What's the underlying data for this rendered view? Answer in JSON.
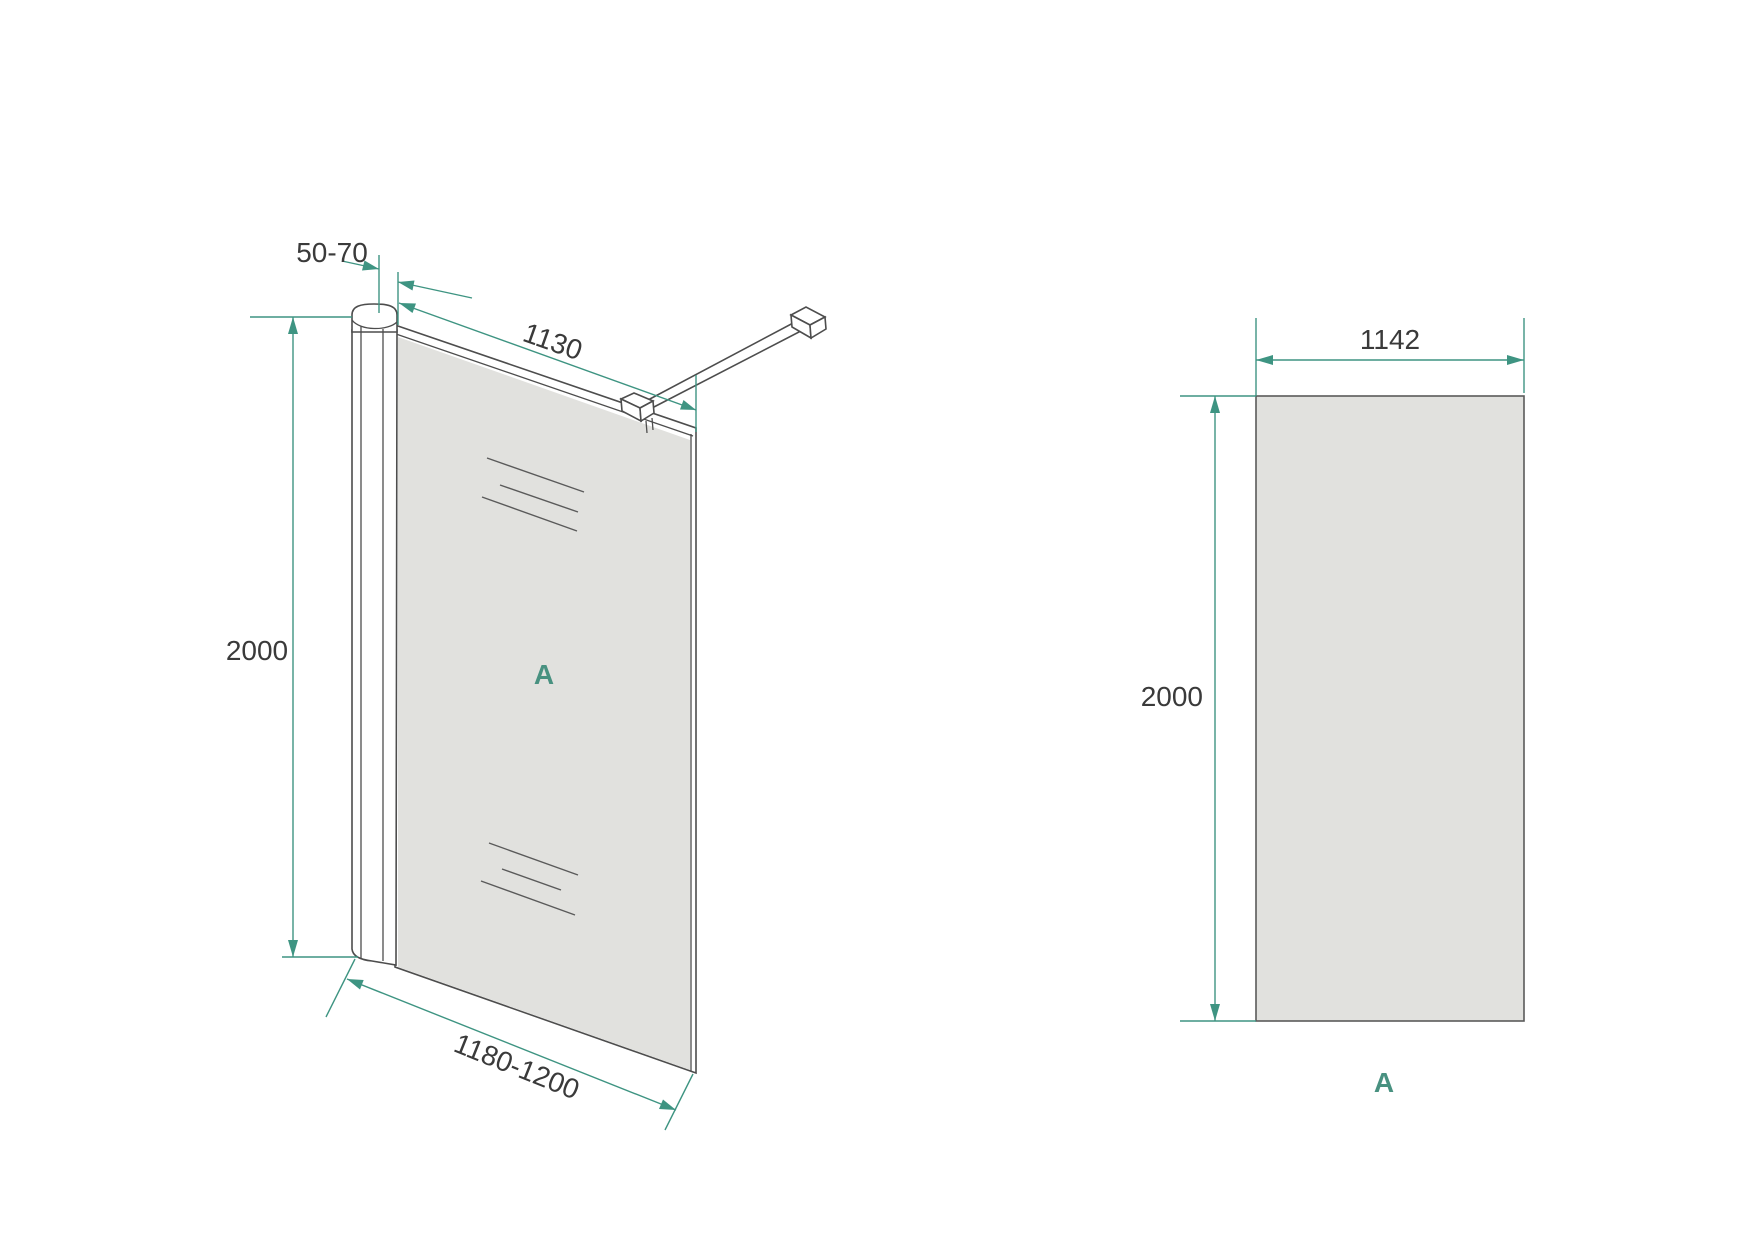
{
  "colors": {
    "accent": "#3E9482",
    "panel_label": "#489180",
    "line": "#4d4d4d",
    "glass_fill": "#E1E1DE",
    "text": "#3a3a3a",
    "background": "#ffffff"
  },
  "side_view": {
    "panel_label": "A",
    "dims": {
      "profile_adjustment": "50-70",
      "glass_width": "1130",
      "height": "2000",
      "install_width": "1180-1200"
    }
  },
  "front_view": {
    "panel_label": "A",
    "dims": {
      "glass_width": "1142",
      "height": "2000"
    }
  }
}
